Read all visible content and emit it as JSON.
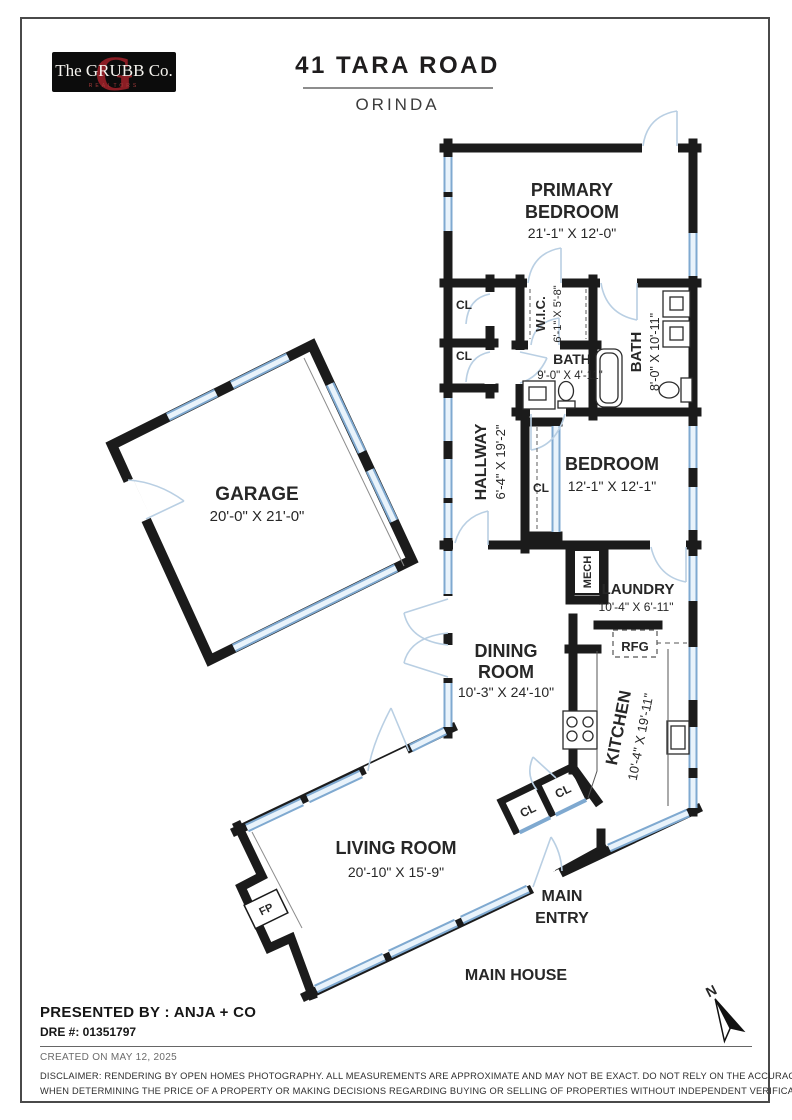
{
  "brand": {
    "the_word": "The GRUBB Co.",
    "tagline": "REALTORS",
    "monogram": "G"
  },
  "header": {
    "title": "41 TARA ROAD",
    "city": "ORINDA"
  },
  "rooms": {
    "primary_bedroom": {
      "line1": "PRIMARY",
      "line2": "BEDROOM",
      "dims": "21'-1\" X 12'-0\""
    },
    "wic": {
      "name": "W.I.C.",
      "dims": "6'-1\" X 5'-8\""
    },
    "bath_hall": {
      "name": "BATH",
      "dims": "9'-0\" X 4'-11\""
    },
    "bath_primary": {
      "name": "BATH",
      "dims": "8'-0\" X 10'-11\""
    },
    "hallway": {
      "name": "HALLWAY",
      "dims": "6'-4\" X 19'-2\""
    },
    "bedroom": {
      "name": "BEDROOM",
      "dims": "12'-1\" X 12'-1\""
    },
    "garage": {
      "name": "GARAGE",
      "dims": "20'-0\" X 21'-0\""
    },
    "laundry": {
      "name": "LAUNDRY",
      "dims": "10'-4\" X 6'-11\""
    },
    "dining": {
      "line1": "DINING",
      "line2": "ROOM",
      "dims": "10'-3\" X 24'-10\""
    },
    "kitchen": {
      "name": "KITCHEN",
      "dims": "10'-4\" X 19'-11\""
    },
    "living": {
      "name": "LIVING ROOM",
      "dims": "20'-10\" X 15'-9\""
    },
    "main_entry": {
      "line1": "MAIN",
      "line2": "ENTRY"
    },
    "main_house": {
      "name": "MAIN HOUSE"
    }
  },
  "tags": {
    "closet": "CL",
    "mech": "MECH",
    "fridge": "RFG",
    "fireplace": "FP"
  },
  "compass": {
    "north": "N"
  },
  "footer": {
    "presented_by": "PRESENTED BY : ANJA + CO",
    "dre": "DRE #: 01351797",
    "created": "CREATED ON MAY 12, 2025",
    "disclaimer_line1": "DISCLAIMER: RENDERING BY OPEN HOMES PHOTOGRAPHY. ALL MEASUREMENTS ARE APPROXIMATE AND MAY NOT BE EXACT. DO NOT RELY ON THE ACCURACY OF THIS FLOOR PLAN",
    "disclaimer_line2": "WHEN DETERMINING THE PRICE OF A PROPERTY OR MAKING DECISIONS REGARDING BUYING OR SELLING OF PROPERTIES WITHOUT INDEPENDENT VERIFICATION."
  },
  "colors": {
    "wall": "#1b1b1b",
    "window_edge": "#7fa9d0",
    "window_fill": "#e9f3fb",
    "arc": "#b9cfe3",
    "brand_red": "#8a1d24"
  }
}
